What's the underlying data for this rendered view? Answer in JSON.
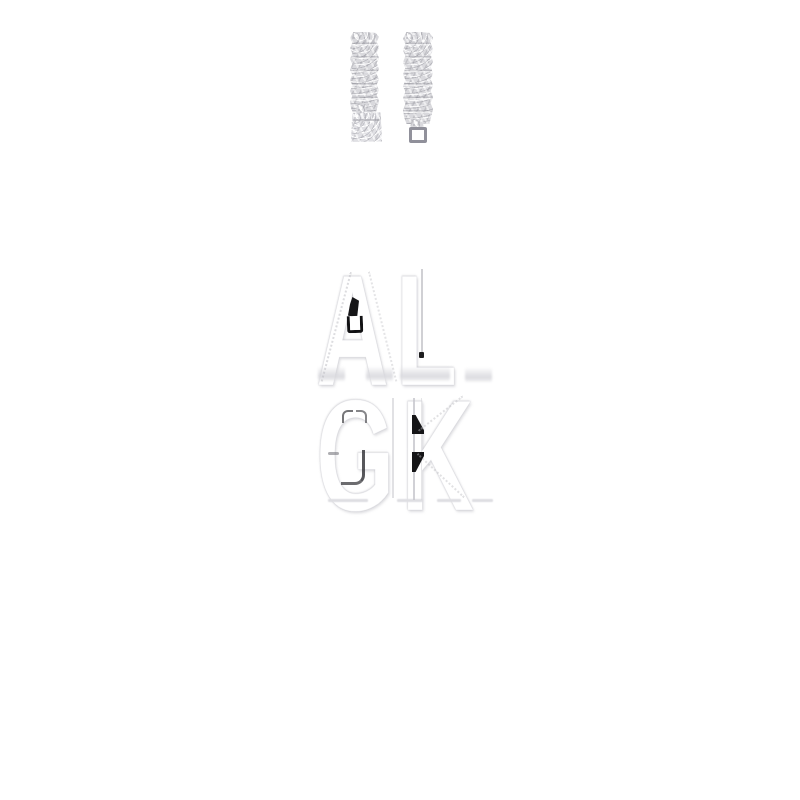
{
  "colors": {
    "bg": "#ffffff",
    "metal": "#d9d9dd",
    "metal-hi": "#f4f4f6",
    "metal-sh": "#a6a6ae",
    "metal-edge": "#b9b9c0",
    "wm-text": "#ffffff",
    "wm-edge": "#c9c9ce",
    "mark-dark": "#151517",
    "smudge": "#dedee2"
  },
  "product_photo": {
    "subject": "silver-pave-cuban-link-bracelet-ends",
    "left_end": "box-clasp",
    "right_end": "insert-tab"
  },
  "watermark": {
    "line1": "AL",
    "line2": "GK"
  }
}
